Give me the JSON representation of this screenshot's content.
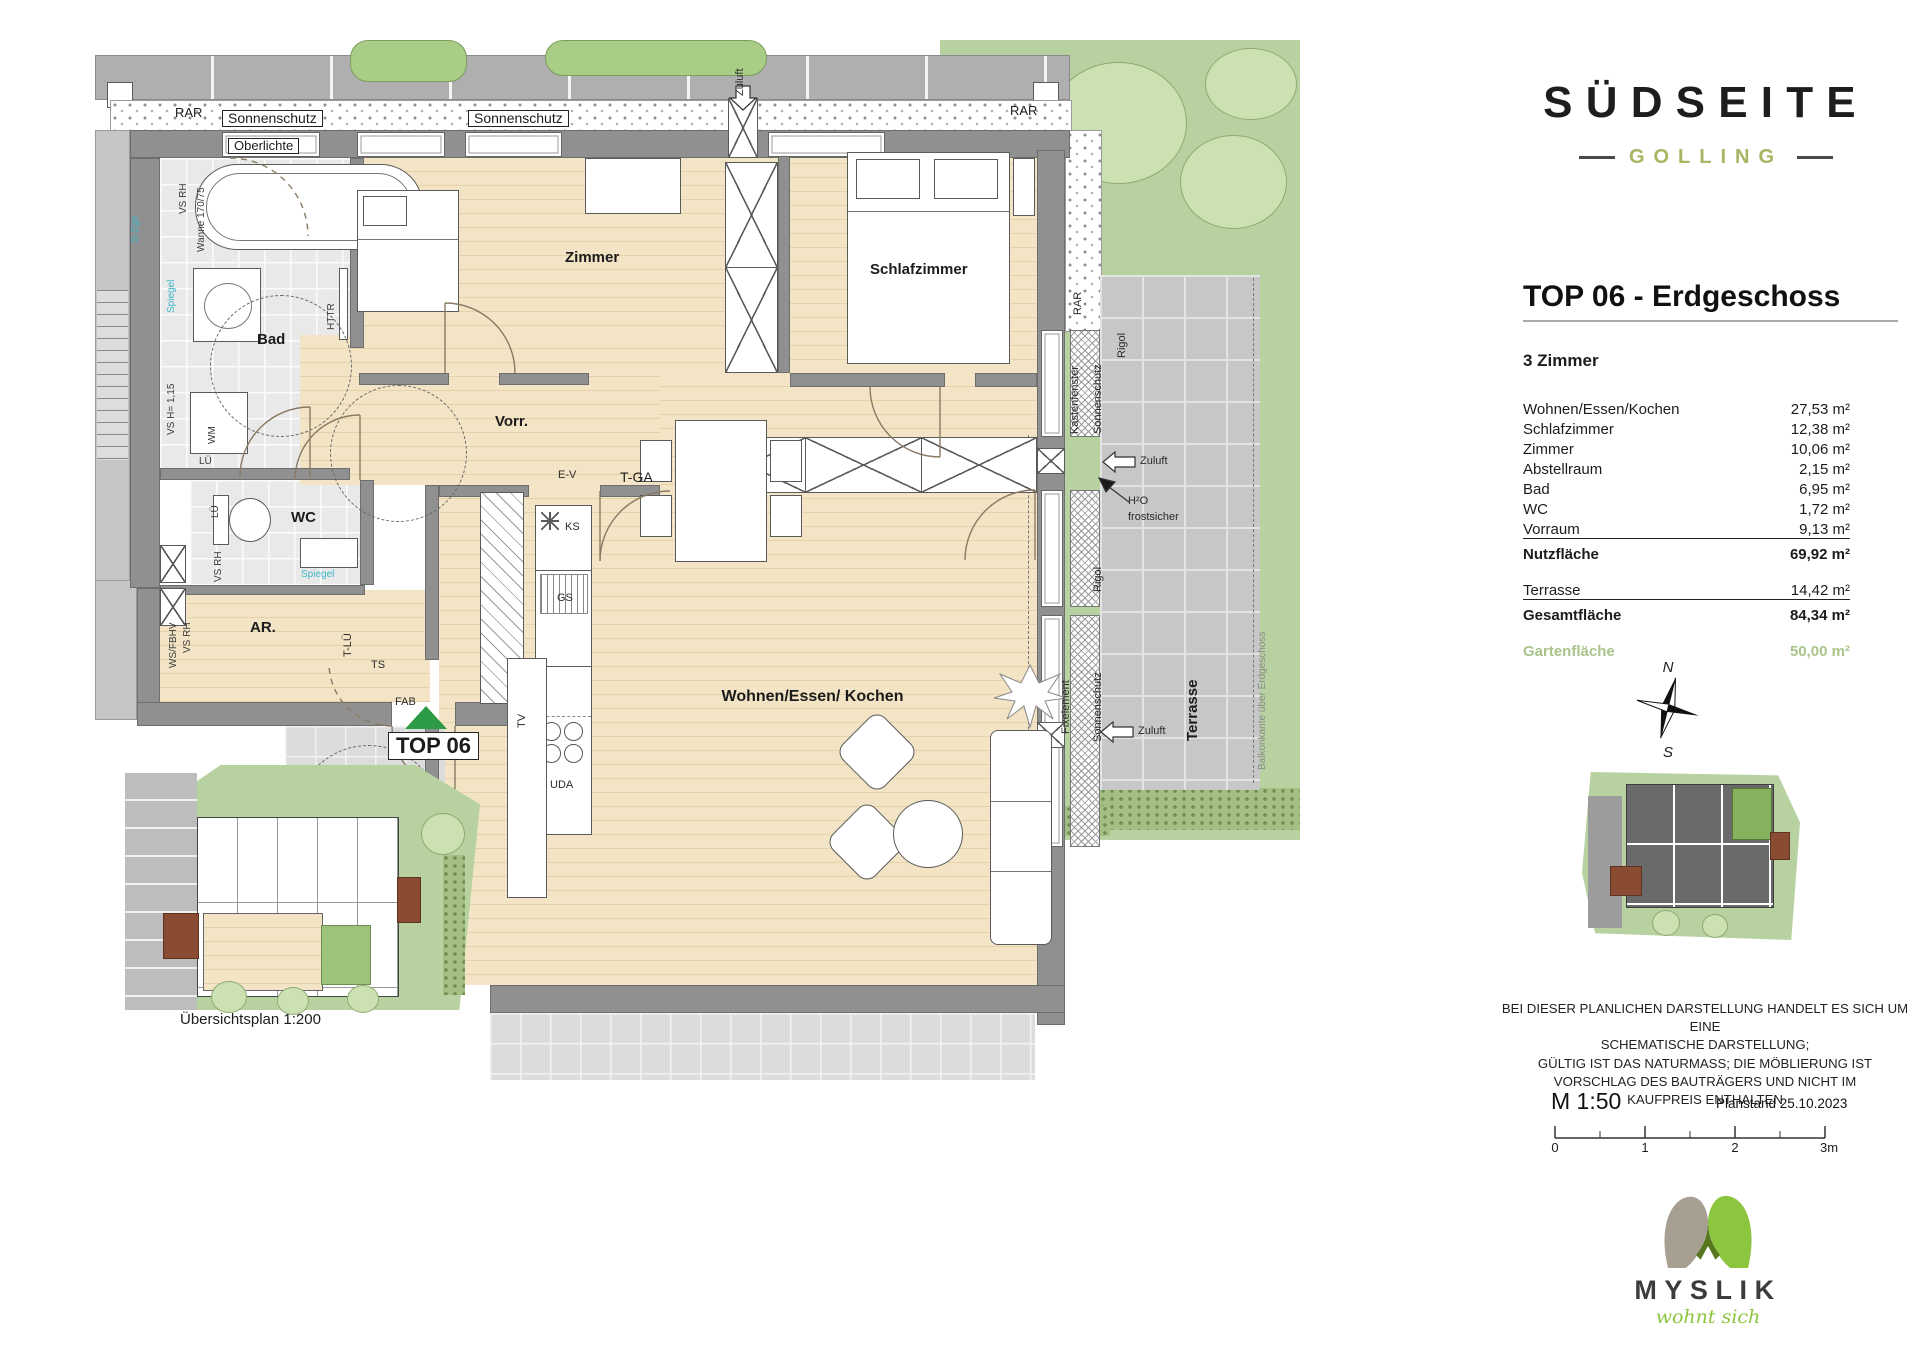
{
  "branding": {
    "project_name": "SÜDSEITE",
    "project_location": "GOLLING",
    "logo_company": "MYSLIK",
    "logo_tagline": "wohnt sich"
  },
  "header": {
    "title": "TOP 06 - Erdgeschoss",
    "rooms_count": "3 Zimmer"
  },
  "area_table": {
    "rows": [
      {
        "label": "Wohnen/Essen/Kochen",
        "value": "27,53 m²"
      },
      {
        "label": "Schlafzimmer",
        "value": "12,38 m²"
      },
      {
        "label": "Zimmer",
        "value": "10,06 m²"
      },
      {
        "label": "Abstellraum",
        "value": "2,15 m²"
      },
      {
        "label": "Bad",
        "value": "6,95 m²"
      },
      {
        "label": "WC",
        "value": "1,72 m²"
      },
      {
        "label": "Vorraum",
        "value": "9,13 m²"
      }
    ],
    "nutzflaeche": {
      "label": "Nutzfläche",
      "value": "69,92 m²"
    },
    "terrasse": {
      "label": "Terrasse",
      "value": "14,42 m²"
    },
    "gesamtflaeche": {
      "label": "Gesamtfläche",
      "value": "84,34 m²"
    },
    "gartenflaeche": {
      "label": "Gartenfläche",
      "value": "50,00 m²"
    }
  },
  "plan": {
    "unit_marker": "TOP 06",
    "rooms": {
      "bad": "Bad",
      "zimmer": "Zimmer",
      "schlafzimmer": "Schlafzimmer",
      "vorraum": "Vorr.",
      "wc": "WC",
      "abstellraum": "AR.",
      "wohnen": "Wohnen/Essen/ Kochen",
      "terrasse": "Terrasse"
    },
    "annotations": {
      "rar": "RAR",
      "sonnenschutz": "Sonnenschutz",
      "oberlichte": "Oberlichte",
      "zuluft": "Zuluft",
      "kastenfenster": "Kastenfenster",
      "rigol": "Rigol",
      "fixelement": "Fixelement",
      "h2o": "H²O",
      "frostsicher": "frostsicher",
      "balkonkante": "Balkonkante über Erdgeschoss",
      "wanne": "Wanne 170/75",
      "vs_rh": "VS RH",
      "vs_h": "VS H= 1,15",
      "ws_fbhv": "WS/FBHV",
      "spiegel": "Spiegel",
      "s_zge": "S-Zge",
      "httr": "HTTR",
      "wm": "WM",
      "lue": "LÜ",
      "t_lue": "T-LÜ",
      "ts": "TS",
      "fab": "FAB",
      "ev": "E-V",
      "t_ga": "T-GA",
      "ks": "KS",
      "gs": "GS",
      "uda": "UDA",
      "tv": "TV"
    },
    "compass": {
      "north": "N",
      "south": "S"
    }
  },
  "overview": {
    "caption": "Übersichtsplan 1:200"
  },
  "footer": {
    "disclaimer": [
      "BEI DIESER PLANLICHEN DARSTELLUNG HANDELT ES SICH UM EINE",
      "SCHEMATISCHE DARSTELLUNG;",
      "GÜLTIG IST DAS NATURMASS; DIE MÖBLIERUNG IST",
      "VORSCHLAG DES BAUTRÄGERS UND NICHT IM",
      "KAUFPREIS ENTHALTEN"
    ],
    "scale": "M 1:50",
    "plan_date": "Planstand 25.10.2023",
    "scale_ticks": [
      "0",
      "1",
      "2",
      "3m"
    ]
  },
  "colors": {
    "accent_green": "#a8b564",
    "garden_green": "#b7d2a0",
    "marker_green": "#2d9b45",
    "myslik_green": "#8cc63f",
    "myslik_taupe": "#a89f93",
    "label_cyan": "#3fb8c9"
  }
}
